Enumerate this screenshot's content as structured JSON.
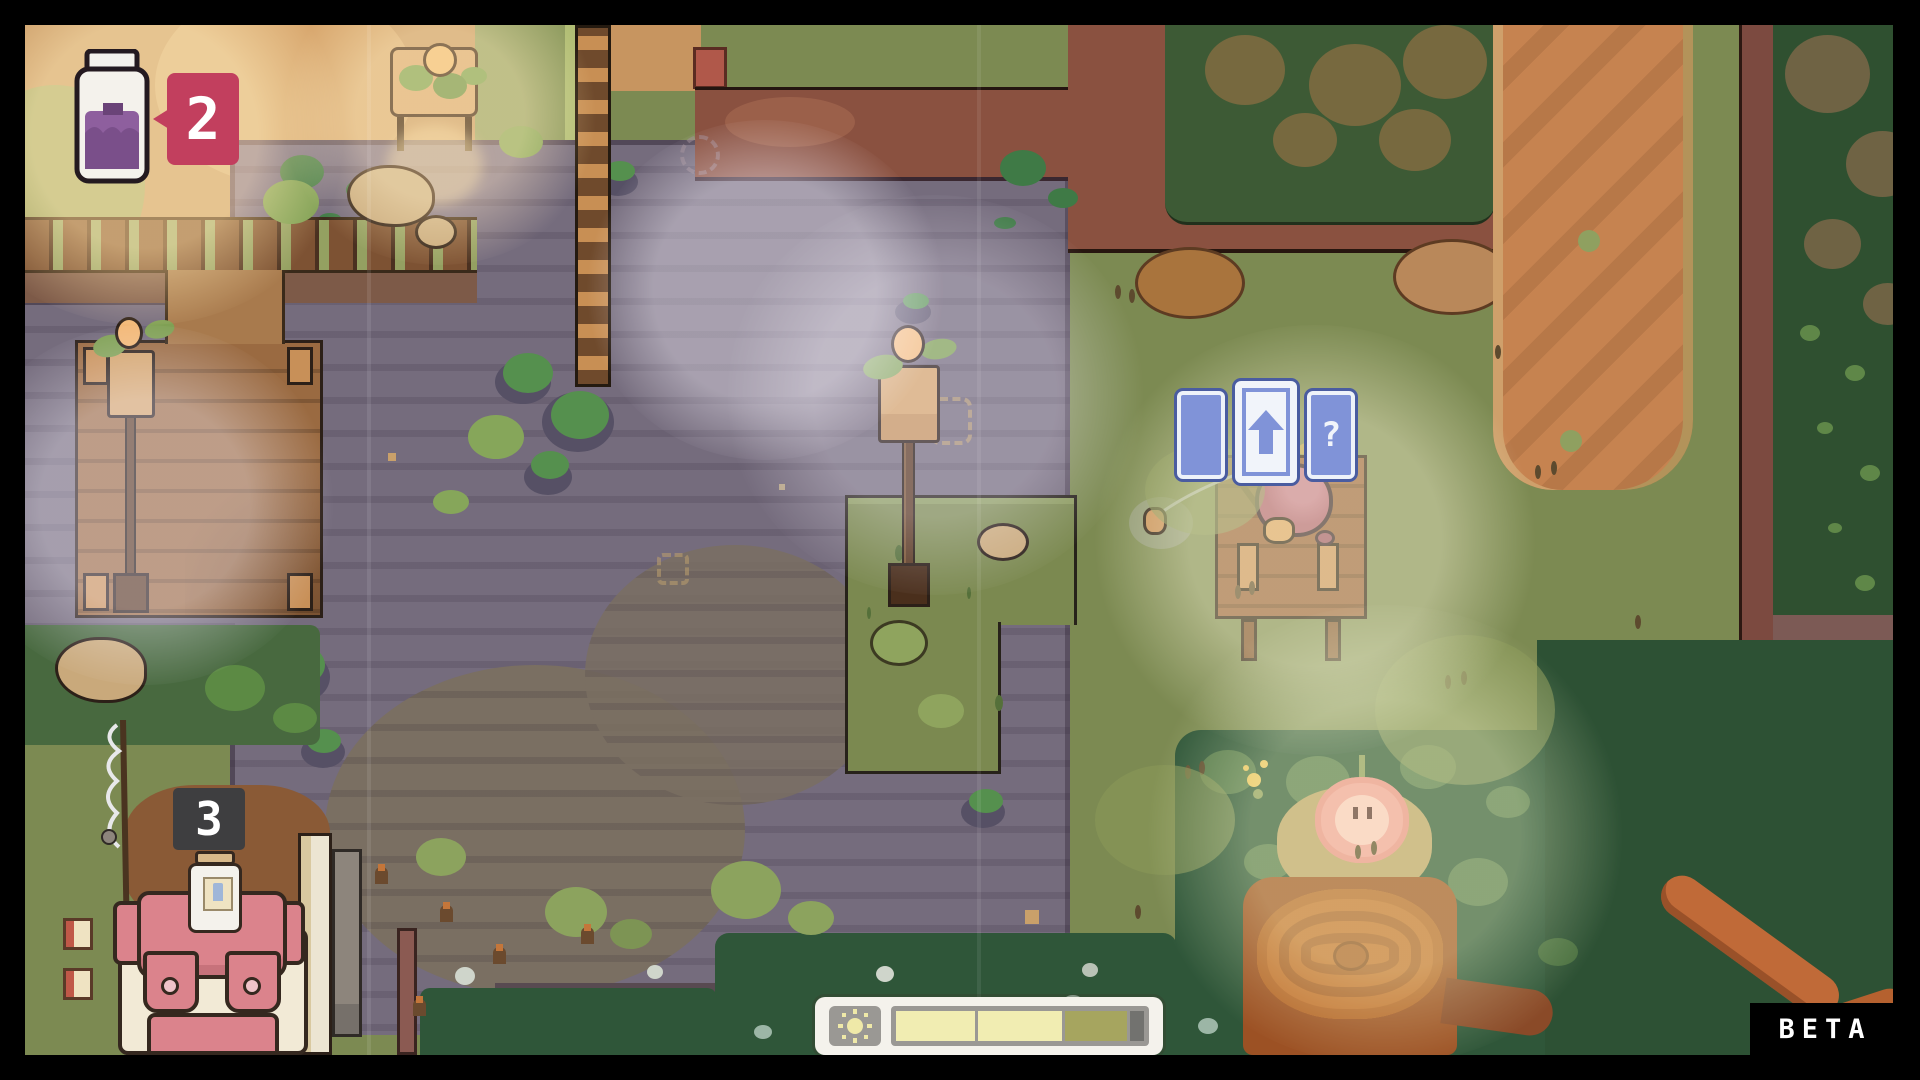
{
  "app": {
    "name": "cozy-pixel-farm-game",
    "build_label": "BETA"
  },
  "hud": {
    "inventory_toast": {
      "icon": "jam-jar-icon",
      "count": "2",
      "badge_color": "#c23f5e"
    },
    "stack_marker": {
      "count": "3",
      "bg_color": "#3e3e40"
    },
    "card_prompt": {
      "border_color": "#4a5ca0",
      "card_color": "#8093d8",
      "selected_color": "#f1f4fa",
      "cards": [
        {
          "name": "card-blank",
          "glyph": "",
          "selected": false
        },
        {
          "name": "card-up-arrow",
          "glyph": "↑",
          "selected": true
        },
        {
          "name": "card-question",
          "glyph": "?",
          "selected": false
        }
      ]
    },
    "day_progress": {
      "icon": "sun-icon",
      "container_color": "#f4f2ec",
      "frame_color": "#9a9894",
      "segments": [
        {
          "color": "#f1edb2",
          "width_pct": 33
        },
        {
          "color": "#f1edb2",
          "width_pct": 35
        },
        {
          "color": "#a6a55f",
          "width_pct": 26
        },
        {
          "color": "#72726f",
          "width_pct": 6
        }
      ]
    },
    "beta_label": "BETA"
  },
  "palette": {
    "grass": "#7c8a52",
    "pond": "#756c7d",
    "pond_streak": "#665e6f",
    "mud": "#7a6f62",
    "ground_tan": "#c79560",
    "cliff": "#8a5140",
    "path_orange": "#c68350",
    "forest": "#2f5030",
    "hedge": "#2f5639",
    "wood": "#9a6b42",
    "wood_light": "#c89058",
    "island": "#7b8950",
    "character_body": "#ac5e6b",
    "stump": "#c0702f",
    "blossom": "#ef9f90",
    "backpack_pink": "#db838c",
    "backpack_cream": "#f2ead6",
    "jar_fill": "#8e5f9e",
    "card_blue": "#8093d8"
  },
  "scene": {
    "character": "apple-creature-fishing",
    "landmarks": [
      "pond",
      "left-dock",
      "fishing-dock",
      "flower-lamp-post-center",
      "flower-lamp-post-dock",
      "planter-bed",
      "center-island",
      "tree-stump",
      "peach-blossom-creature",
      "backpack",
      "fence-row",
      "forest-edge"
    ]
  }
}
